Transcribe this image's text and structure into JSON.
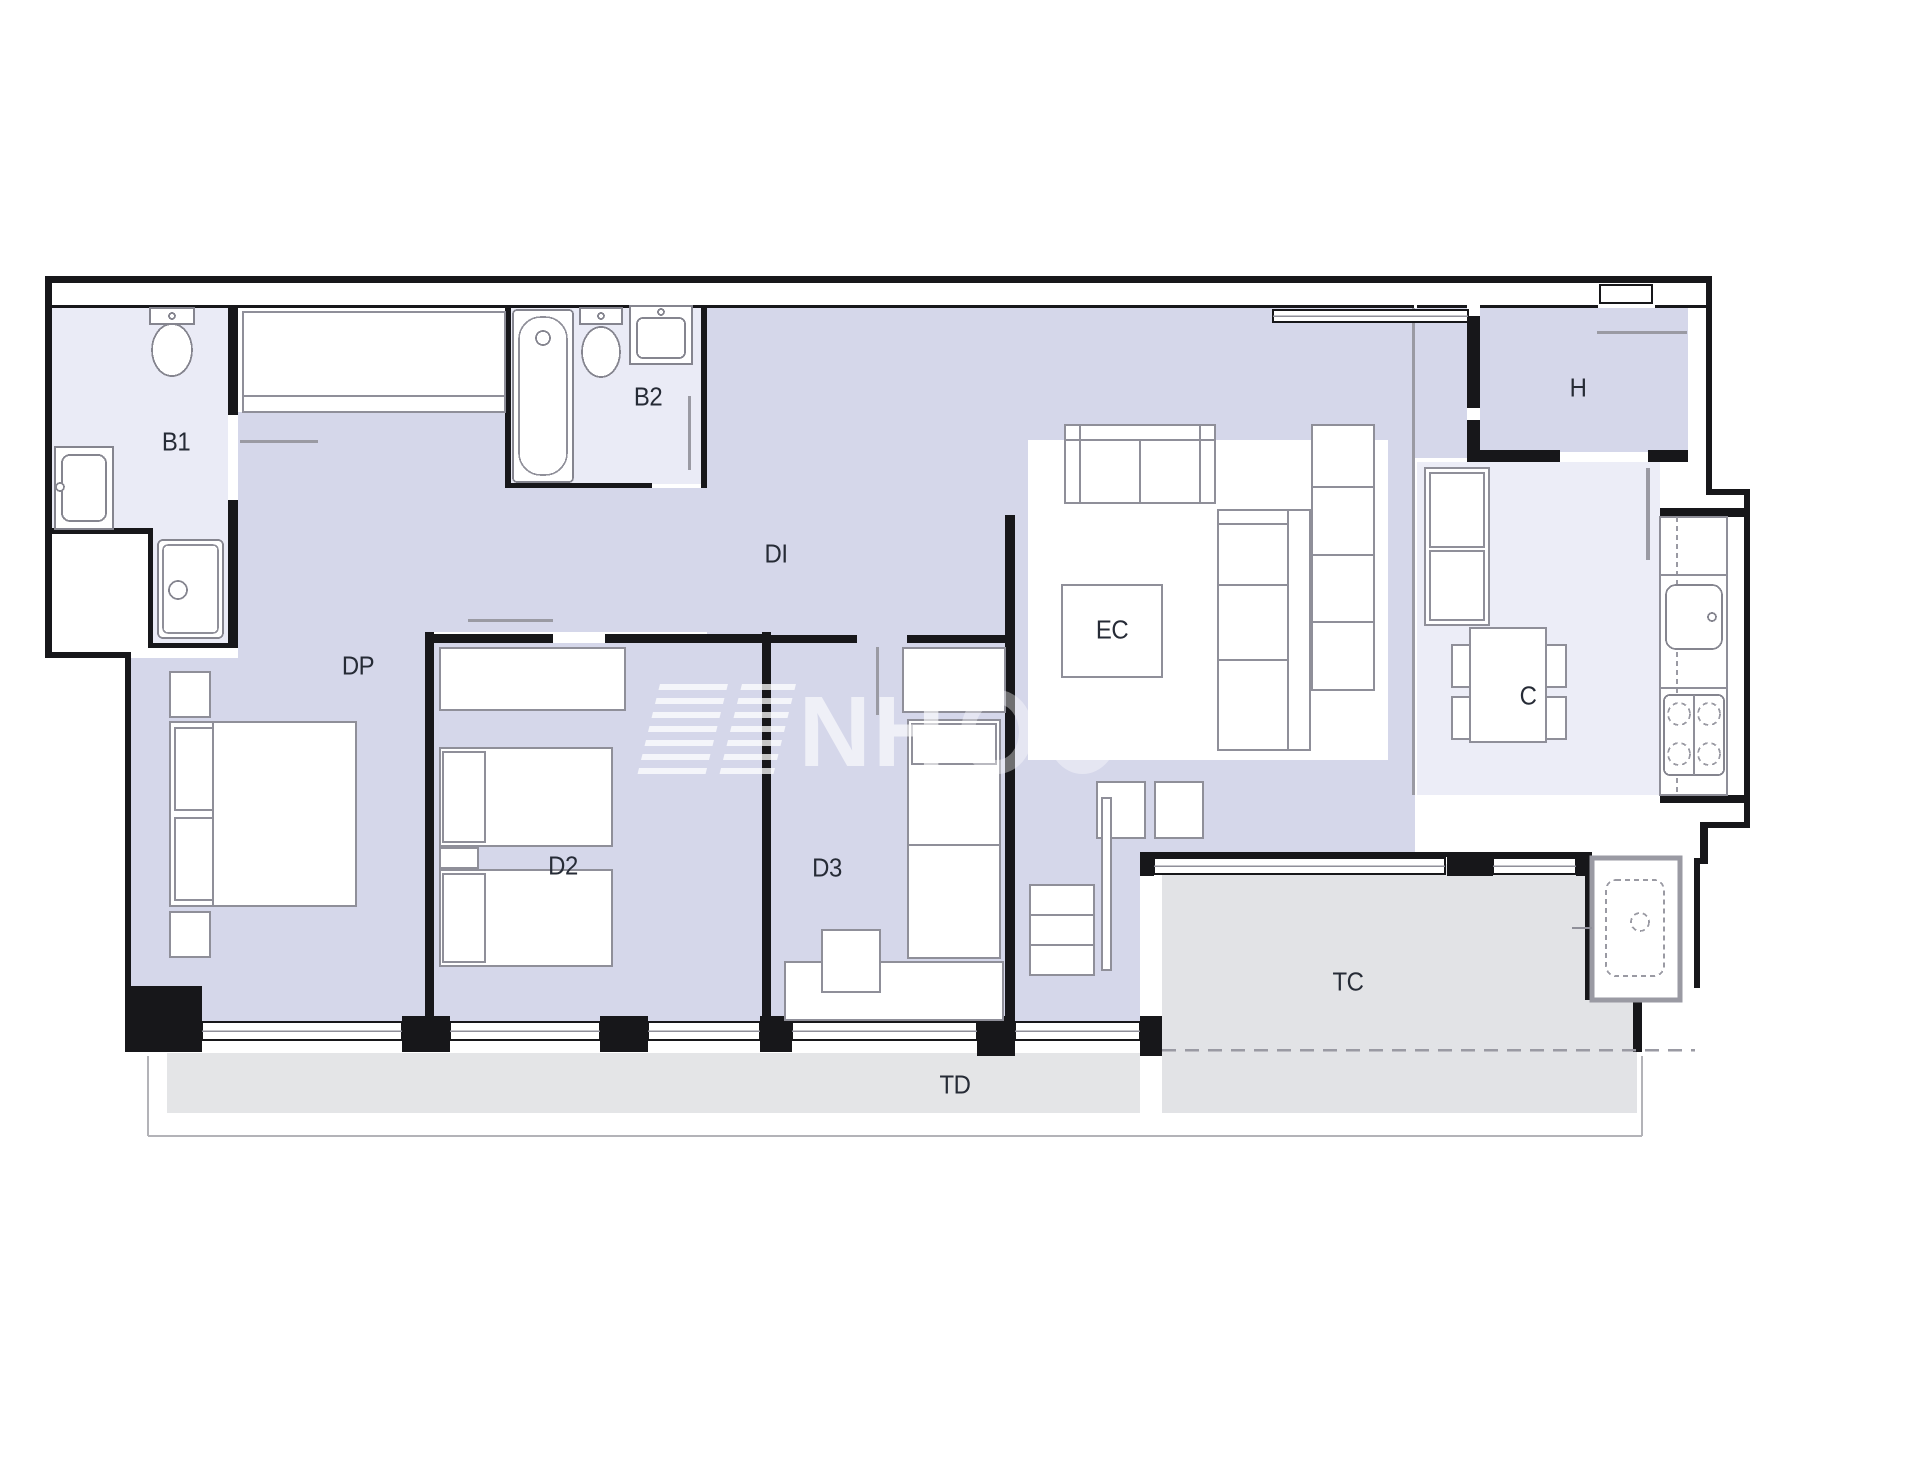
{
  "plan": {
    "title": "apartment floor plan",
    "watermark": {
      "text": "NH"
    },
    "rooms": [
      {
        "code": "B1",
        "name": "bathroom-1"
      },
      {
        "code": "B2",
        "name": "bathroom-2"
      },
      {
        "code": "DI",
        "name": "hallway-distributor"
      },
      {
        "code": "DP",
        "name": "master-bedroom"
      },
      {
        "code": "D2",
        "name": "bedroom-2"
      },
      {
        "code": "D3",
        "name": "bedroom-3"
      },
      {
        "code": "EC",
        "name": "living-dining-room"
      },
      {
        "code": "H",
        "name": "entrance-hall"
      },
      {
        "code": "C",
        "name": "kitchen"
      },
      {
        "code": "TC",
        "name": "covered-terrace"
      },
      {
        "code": "TD",
        "name": "open-terrace"
      }
    ],
    "colors": {
      "room_fill": "#d5d7ea",
      "wet_room_fill": "#eaebf6",
      "terrace_fill": "#e2e3e6",
      "wall": "#17171a",
      "furniture_stroke": "#8f8f99"
    }
  }
}
